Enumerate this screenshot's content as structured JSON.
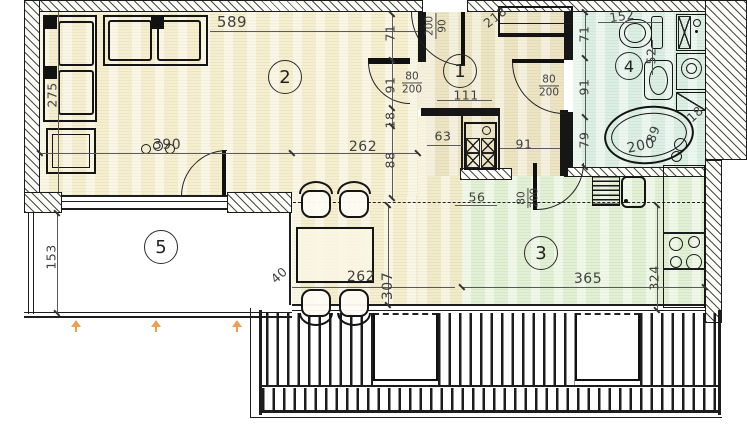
{
  "rooms": {
    "hallway": "1",
    "living": "2",
    "kitchen": "3",
    "bathroom": "4",
    "terrace": "5"
  },
  "dimensions": {
    "living_top_width": "589",
    "sofa_depth": "275",
    "living_left_width": "390",
    "living_right_width": "262",
    "hall_wall_offset": "71",
    "living_door_span": "91",
    "wall_gap": "18",
    "living_wall_lower": "88",
    "living_door_width": "80",
    "living_door_height": "200",
    "niche_width": "63",
    "hall_width": "111",
    "entry_door_height": "200",
    "entry_door_width": "90",
    "entry_width": "218",
    "bath_top_width": "152",
    "bath_fixture": "52",
    "bath_offset_top": "71",
    "bath_mid": "91",
    "bath_lower": "79",
    "bath_door_width": "80",
    "bath_door_height": "200",
    "lobby_width": "91",
    "lobby_return": "56",
    "kitchen_door_width": "80",
    "kitchen_door_height": "200",
    "tub_length": "200",
    "tub_width": "89",
    "kitchen_gap": "18",
    "kitchen_width": "365",
    "kitchen_depth": "324",
    "dining_depth": "307",
    "dining_width": "262",
    "dining_offset": "40",
    "terrace_depth": "153"
  },
  "colors": {
    "living_fill": "#f5efd0",
    "hall_fill": "#ece4c3",
    "kitchen_fill": "#e2f0d5",
    "bath_fill": "#dcefe5",
    "wall_ink": "#1a1a1a",
    "anchor_orange": "#ef9f55"
  }
}
